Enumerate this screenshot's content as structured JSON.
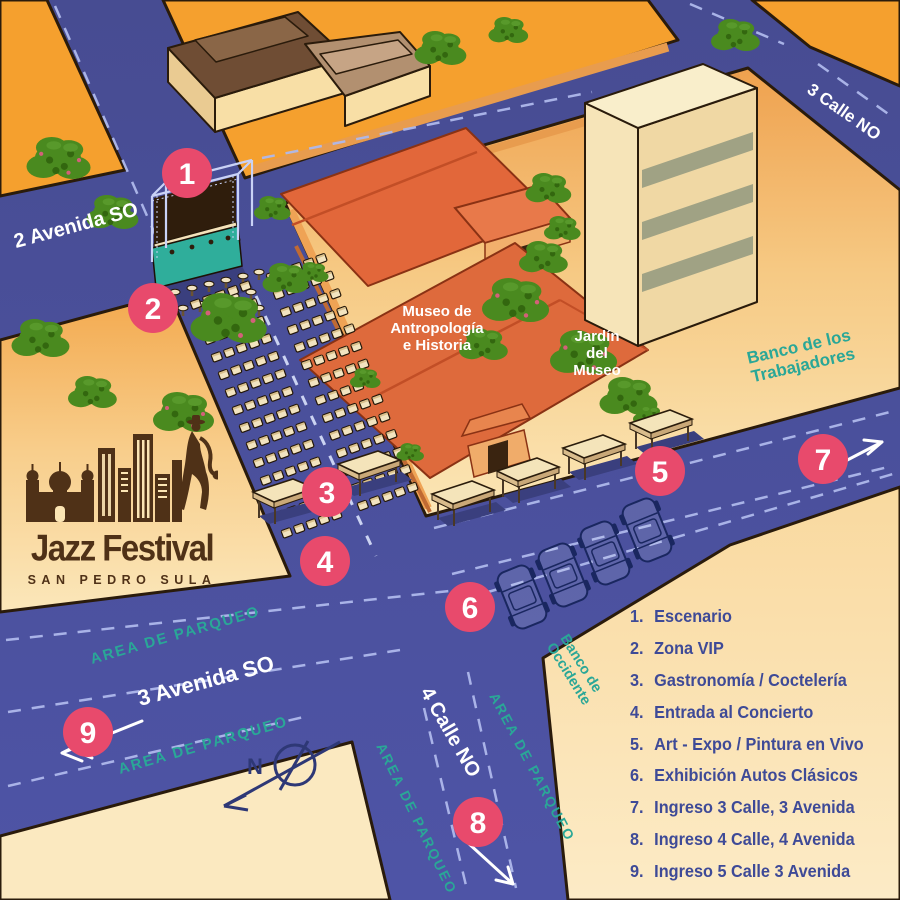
{
  "logo": {
    "title": "Jazz Festival",
    "subtitle": "SAN PEDRO SULA"
  },
  "streets": {
    "avenida2": "2 Avenida SO",
    "calle3": "3 Calle NO",
    "avenida3": "3 Avenida SO",
    "calle4": "4 Calle NO"
  },
  "labels": {
    "parqueo": "AREA DE PARQUEO",
    "museo_l1": "Museo de",
    "museo_l2": "Antropología",
    "museo_l3": "e Historia",
    "jardin_l1": "Jardín",
    "jardin_l2": "del",
    "jardin_l3": "Museo",
    "banco_trab_l1": "Banco de los",
    "banco_trab_l2": "Trabajadores",
    "banco_occ_l1": "Banco de",
    "banco_occ_l2": "Occidente",
    "compass_n": "N"
  },
  "markers": [
    {
      "num": "1",
      "x": 187,
      "y": 173
    },
    {
      "num": "2",
      "x": 153,
      "y": 308
    },
    {
      "num": "3",
      "x": 327,
      "y": 492
    },
    {
      "num": "4",
      "x": 325,
      "y": 561
    },
    {
      "num": "5",
      "x": 660,
      "y": 471
    },
    {
      "num": "6",
      "x": 470,
      "y": 607
    },
    {
      "num": "7",
      "x": 823,
      "y": 459
    },
    {
      "num": "8",
      "x": 478,
      "y": 822
    },
    {
      "num": "9",
      "x": 88,
      "y": 732
    }
  ],
  "legend": {
    "items": [
      {
        "n": "1.",
        "label": "Escenario"
      },
      {
        "n": "2.",
        "label": "Zona VIP"
      },
      {
        "n": "3.",
        "label": "Gastronomía / Coctelería"
      },
      {
        "n": "4.",
        "label": "Entrada al Concierto"
      },
      {
        "n": "5.",
        "label": "Art - Expo / Pintura en Vivo"
      },
      {
        "n": "6.",
        "label": "Exhibición Autos Clásicos"
      },
      {
        "n": "7.",
        "label": "Ingreso 3 Calle, 3 Avenida"
      },
      {
        "n": "8.",
        "label": "Ingreso 4 Calle, 4 Avenida"
      },
      {
        "n": "9.",
        "label": "Ingreso 5 Calle 3 Avenida"
      }
    ]
  },
  "colors": {
    "street": "#4B51A0",
    "marker": "#E84A6C",
    "teal": "#2AA797",
    "legend_text": "#3E4A97",
    "orange_block": "#F5A02E",
    "cream_block": "#FBE7BC",
    "logo_brown": "#4F3117"
  }
}
